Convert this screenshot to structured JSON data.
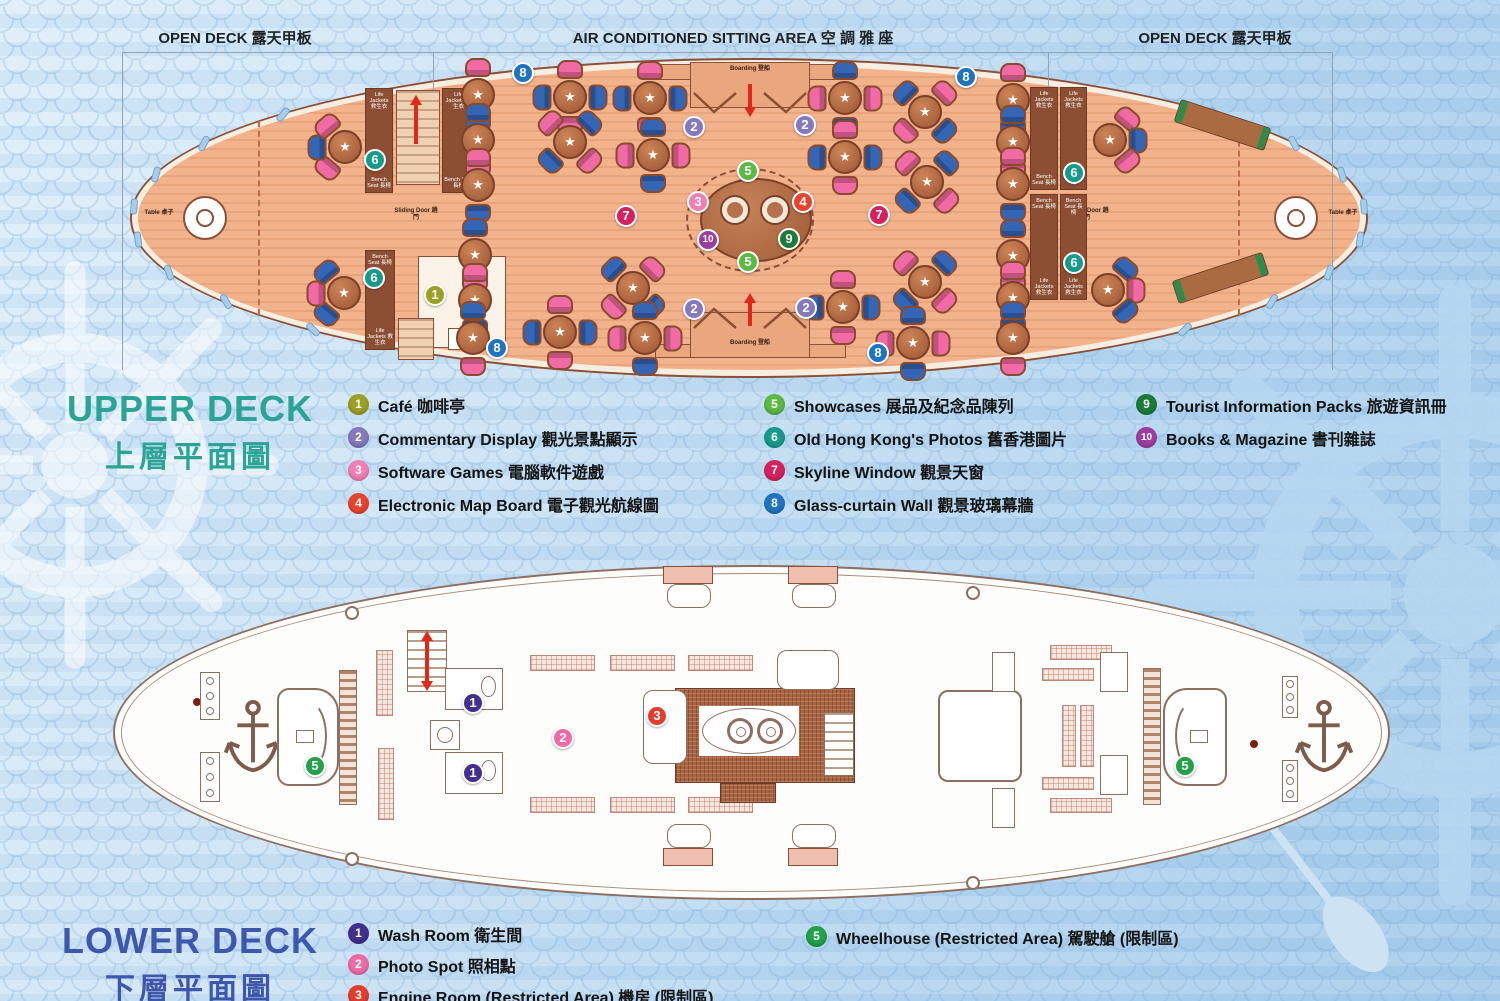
{
  "header": {
    "zones": [
      {
        "label": "OPEN DECK 露天甲板"
      },
      {
        "label": "AIR CONDITIONED SITTING AREA 空 調 雅 座"
      },
      {
        "label": "OPEN DECK 露天甲板"
      }
    ]
  },
  "icons": {
    "table_star": "★"
  },
  "upper_deck": {
    "title_en": "UPPER DECK",
    "title_zh": "上層平面圖",
    "title_color": "#2ba496",
    "plan_labels": {
      "table": "Table 桌子",
      "sliding_door": "Sliding Door 趟門",
      "boarding": "Boarding 登船",
      "life_jackets": "Life Jackets 救生衣",
      "bench_seat": "Bench Seat 長椅"
    },
    "legend": [
      {
        "n": 1,
        "label": "Café 咖啡亭",
        "color": "#9aa024"
      },
      {
        "n": 2,
        "label": "Commentary Display 觀光景點顯示",
        "color": "#8678bc"
      },
      {
        "n": 3,
        "label": "Software Games 電腦軟件遊戲",
        "color": "#f07fb4"
      },
      {
        "n": 4,
        "label": "Electronic Map Board 電子觀光航線圖",
        "color": "#e8432e"
      },
      {
        "n": 5,
        "label": "Showcases 展品及紀念品陳列",
        "color": "#5cb943"
      },
      {
        "n": 6,
        "label": "Old Hong Kong's Photos 舊香港圖片",
        "color": "#169a8c"
      },
      {
        "n": 7,
        "label": "Skyline Window 觀景天窗",
        "color": "#d6215f"
      },
      {
        "n": 8,
        "label": "Glass-curtain Wall 觀景玻璃幕牆",
        "color": "#1f74c2"
      },
      {
        "n": 9,
        "label": "Tourist Information Packs 旅遊資訊冊",
        "color": "#1b7c3a"
      },
      {
        "n": 10,
        "label": "Books & Magazine 書刊雜誌",
        "color": "#9b3f9e"
      }
    ],
    "markers": [
      {
        "n": 8,
        "x": 523,
        "y": 73
      },
      {
        "n": 8,
        "x": 966,
        "y": 77
      },
      {
        "n": 8,
        "x": 497,
        "y": 348
      },
      {
        "n": 8,
        "x": 878,
        "y": 353
      },
      {
        "n": 2,
        "x": 694,
        "y": 127
      },
      {
        "n": 2,
        "x": 805,
        "y": 125
      },
      {
        "n": 2,
        "x": 694,
        "y": 309
      },
      {
        "n": 2,
        "x": 806,
        "y": 308
      },
      {
        "n": 6,
        "x": 375,
        "y": 160
      },
      {
        "n": 6,
        "x": 374,
        "y": 278
      },
      {
        "n": 6,
        "x": 1074,
        "y": 173
      },
      {
        "n": 6,
        "x": 1074,
        "y": 263
      },
      {
        "n": 1,
        "x": 435,
        "y": 295
      },
      {
        "n": 5,
        "x": 748,
        "y": 171
      },
      {
        "n": 5,
        "x": 748,
        "y": 262
      },
      {
        "n": 3,
        "x": 698,
        "y": 202
      },
      {
        "n": 4,
        "x": 803,
        "y": 202
      },
      {
        "n": 10,
        "x": 708,
        "y": 240
      },
      {
        "n": 9,
        "x": 789,
        "y": 239
      },
      {
        "n": 7,
        "x": 626,
        "y": 216
      },
      {
        "n": 7,
        "x": 879,
        "y": 215
      }
    ]
  },
  "lower_deck": {
    "title_en": "LOWER DECK",
    "title_zh": "下層平面圖",
    "title_color": "#3f57ab",
    "legend": [
      {
        "n": 1,
        "label": "Wash Room 衛生間",
        "color": "#432f8e"
      },
      {
        "n": 2,
        "label": "Photo Spot 照相點",
        "color": "#ef6ba5"
      },
      {
        "n": 3,
        "label": "Engine Room (Restricted Area) 機房 (限制區)",
        "color": "#e23c2d"
      },
      {
        "n": 5,
        "label": "Wheelhouse (Restricted Area) 駕駛艙 (限制區)",
        "color": "#21a149"
      }
    ],
    "markers": [
      {
        "n": 1,
        "x": 473,
        "y": 703
      },
      {
        "n": 1,
        "x": 473,
        "y": 773
      },
      {
        "n": 2,
        "x": 563,
        "y": 738
      },
      {
        "n": 3,
        "x": 657,
        "y": 716
      },
      {
        "n": 5,
        "x": 315,
        "y": 766
      },
      {
        "n": 5,
        "x": 1185,
        "y": 766
      }
    ]
  },
  "palette": {
    "seat_pink": "#ee5f9b",
    "seat_blue": "#3060b2",
    "deck_wood": "#f2b28b",
    "hull_outline": "#8a4f38",
    "background_blue": "#bcd9f0"
  }
}
